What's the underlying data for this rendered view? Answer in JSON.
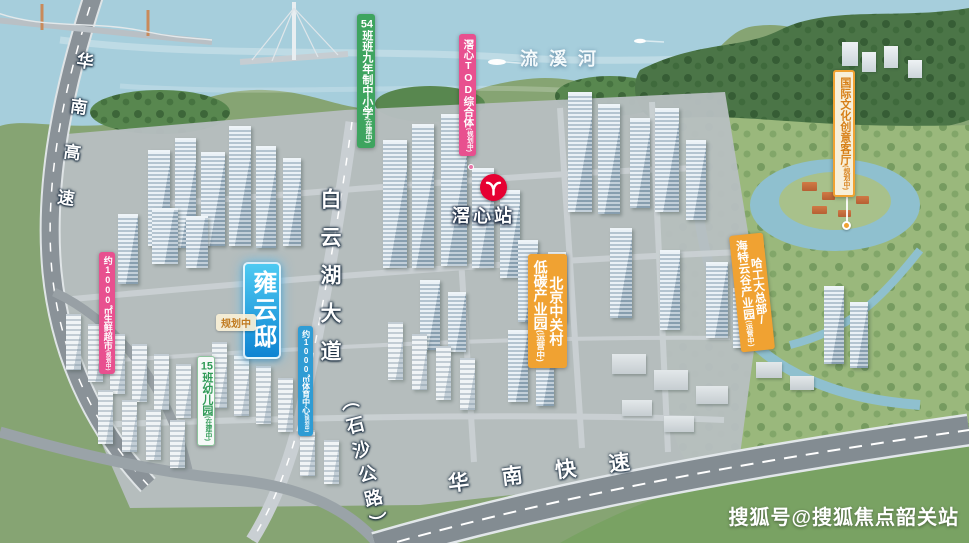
{
  "watermark": {
    "text": "搜狐号@搜狐焦点韶关站"
  },
  "colors": {
    "metro-red": "#e60032",
    "green": "#3ea45f",
    "pink": "#e8508f",
    "blue": "#2f9cd4",
    "orange": "#f0a232",
    "cream": "#f8efd8",
    "cream-text": "#d77f17",
    "mint-text": "#2e9a55",
    "project-a": "#4ecaf2",
    "project-b": "#0e84d2",
    "note-text": "#c07a20"
  },
  "map": {
    "river": {
      "name": "流溪河"
    },
    "roads": {
      "left_expressway": "华南高速",
      "bottom_expressway": "华南快速",
      "avenue": "白云湖大道",
      "avenue_alias": "（石沙公路）"
    },
    "metro": {
      "station": "滘心站"
    },
    "project": {
      "name": "雍云邸"
    },
    "note": {
      "text": "规划中"
    },
    "poi": {
      "school": {
        "num": "54",
        "text": "班班九年制中小学",
        "status": "(在建中)"
      },
      "tod": {
        "text": "滘心TOD综合体",
        "status": "(规划中)"
      },
      "culture": {
        "text": "国际文化创意客厅",
        "status": "(规划中)"
      },
      "supermarket": {
        "text": "约1000㎡生鲜超市",
        "status": "(规划中)"
      },
      "kindergarten": {
        "num": "15",
        "text": "班幼儿园",
        "status": "(在建中)"
      },
      "sports": {
        "text": "约1000㎡体育中心",
        "status": "(规划中)"
      },
      "zgc": {
        "line1": "北京中关村",
        "line2": "低碳产业园",
        "status": "(运营中)"
      },
      "hit": {
        "line1": "哈工大总部/",
        "line2": "海特云谷产业园",
        "status": "(运营中)"
      }
    }
  }
}
